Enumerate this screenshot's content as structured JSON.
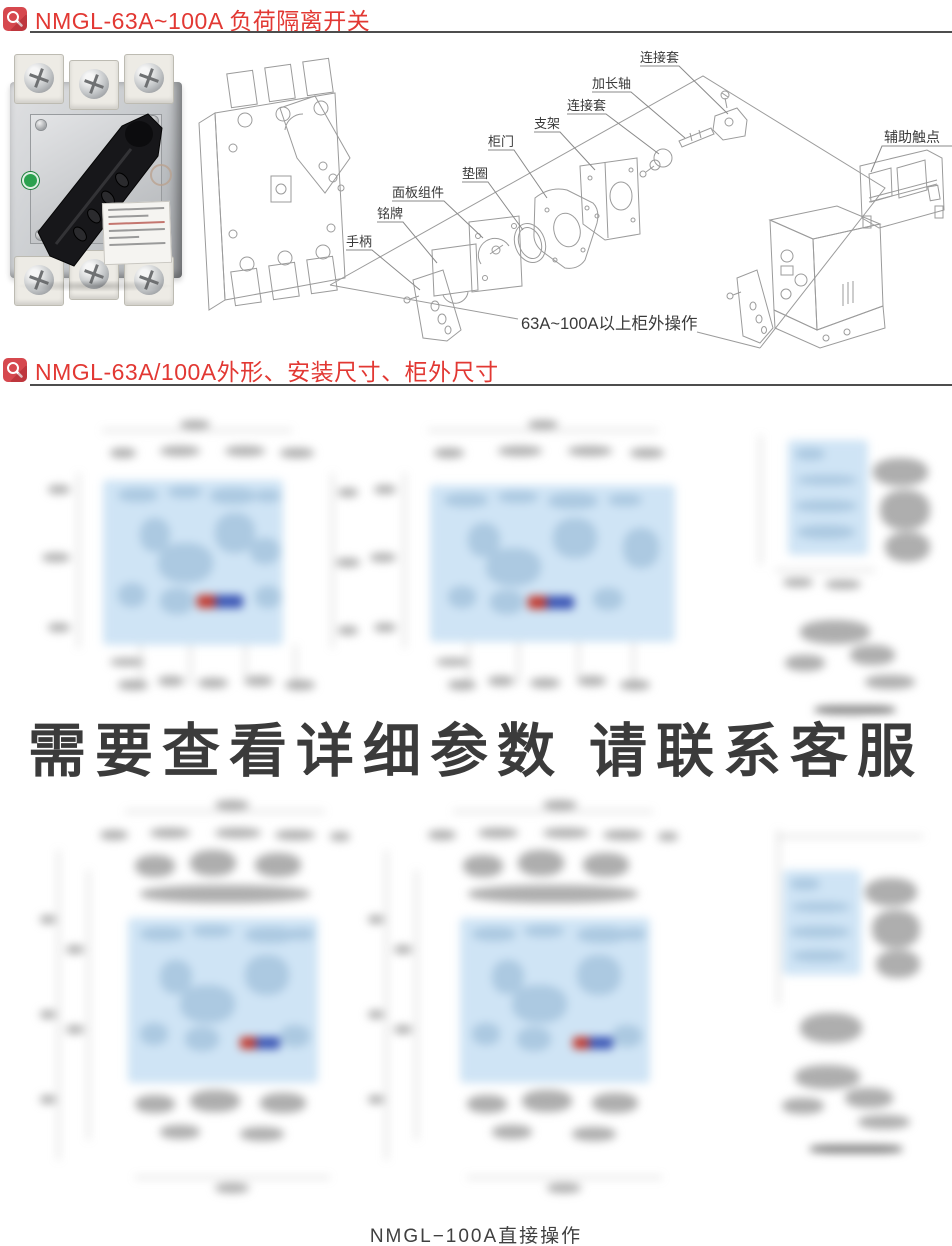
{
  "colors": {
    "accent_red": "#e23833",
    "icon_red": "#d6484e",
    "underline_gray": "#4d4d4d",
    "blur_blue": "#cfe4f5",
    "text_dark": "#3b3b3b",
    "line_gray": "#9b9b9b"
  },
  "header1": {
    "title": "NMGL-63A~100A 负荷隔离开关"
  },
  "header2": {
    "title": "NMGL-63A/100A外形、安装尺寸、柜外尺寸"
  },
  "exploded": {
    "labels": {
      "sleeve1": "连接套",
      "shaft": "加长轴",
      "sleeve2": "连接套",
      "bracket": "支架",
      "door": "柜门",
      "gasket": "垫圈",
      "panel": "面板组件",
      "nameplate": "铭牌",
      "handle": "手柄",
      "aux": "辅助触点"
    },
    "caption": "63A~100A以上柜外操作"
  },
  "overlay": {
    "text": "需要查看详细参数 请联系客服"
  },
  "footer": {
    "caption": "NMGL−100A直接操作"
  }
}
